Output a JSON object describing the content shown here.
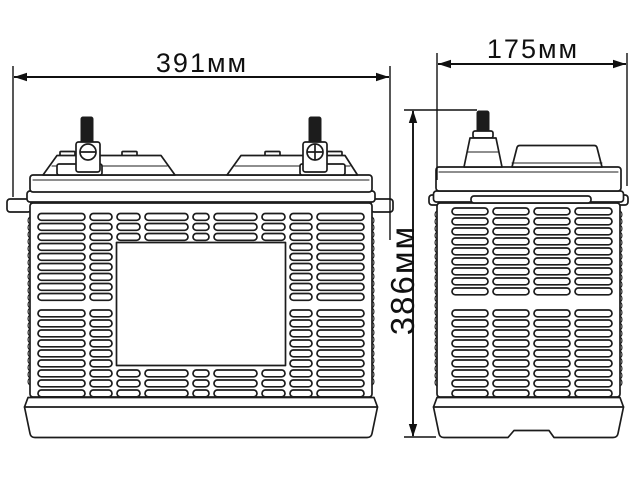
{
  "diagram": {
    "background": "#ffffff",
    "line_color": "#1c1c1c",
    "text_color": "#101010",
    "views": {
      "front": {
        "name": "battery front view"
      },
      "side": {
        "name": "battery side view"
      }
    },
    "dimensions": {
      "front_width": {
        "label": "391мм",
        "value_mm": 391
      },
      "side_depth": {
        "label": "175мм",
        "value_mm": 175
      },
      "height": {
        "label": "386мм",
        "value_mm": 386
      }
    }
  }
}
